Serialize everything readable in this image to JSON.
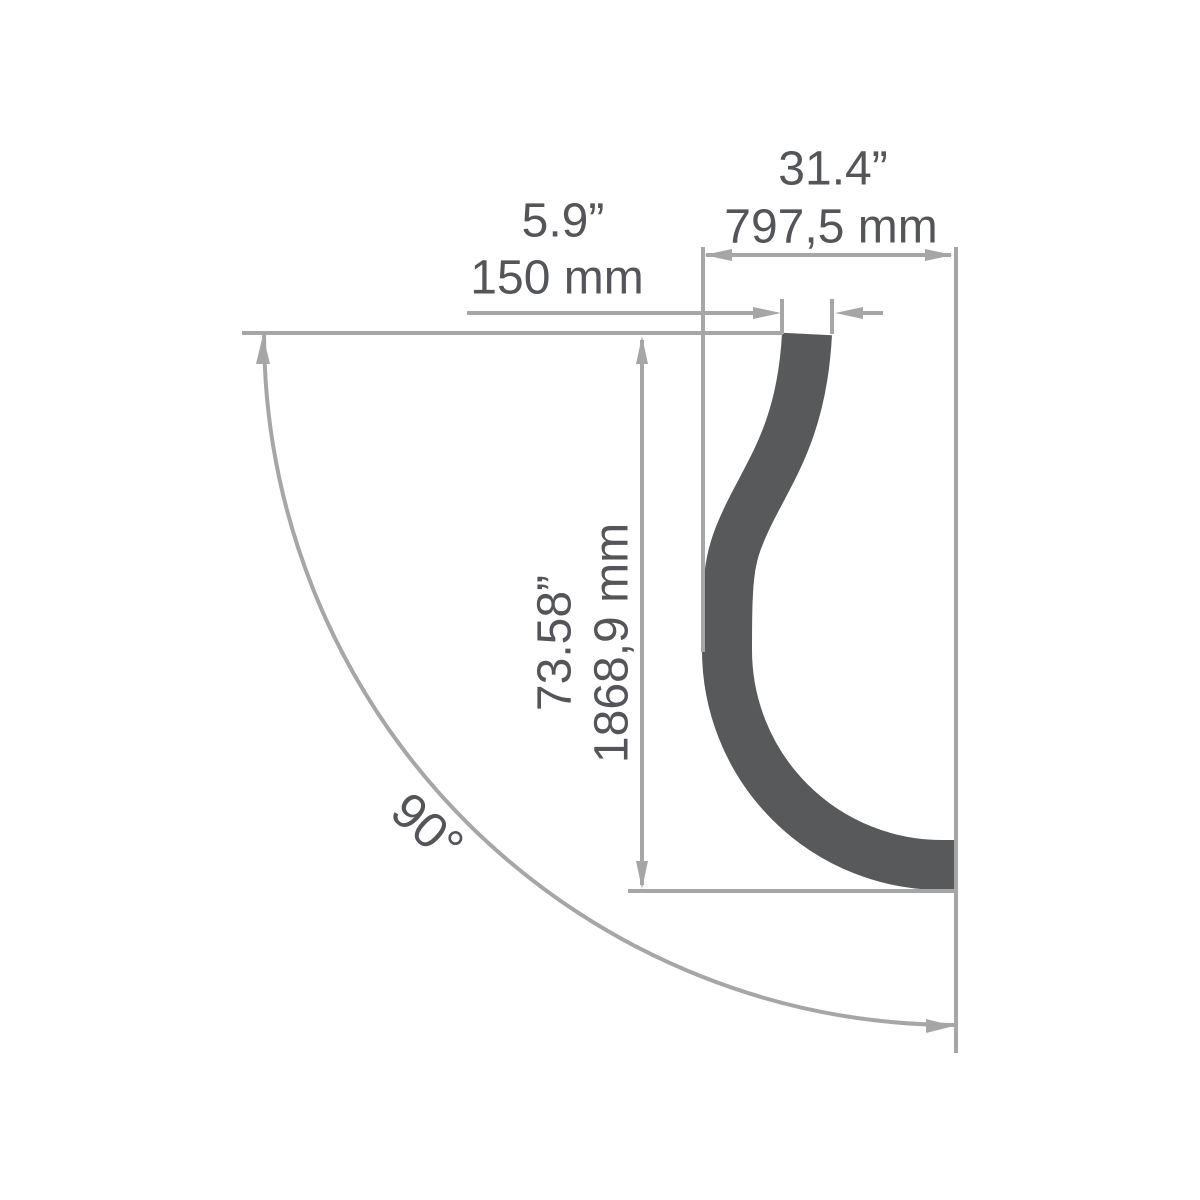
{
  "drawing": {
    "kind": "dimension-drawing-90-degree-bent-profile",
    "labels": {
      "top_width_in": "31.4”",
      "top_width_mm": "797,5 mm",
      "profile_width_in": "5.9”",
      "profile_width_mm": "150 mm",
      "height_in": "73.58”",
      "height_mm": "1868,9 mm",
      "bend_angle": "90°"
    }
  },
  "colors": {
    "profile": "#58595b",
    "line": "#a6a6a6",
    "text": "#545559",
    "background": "#ffffff"
  }
}
